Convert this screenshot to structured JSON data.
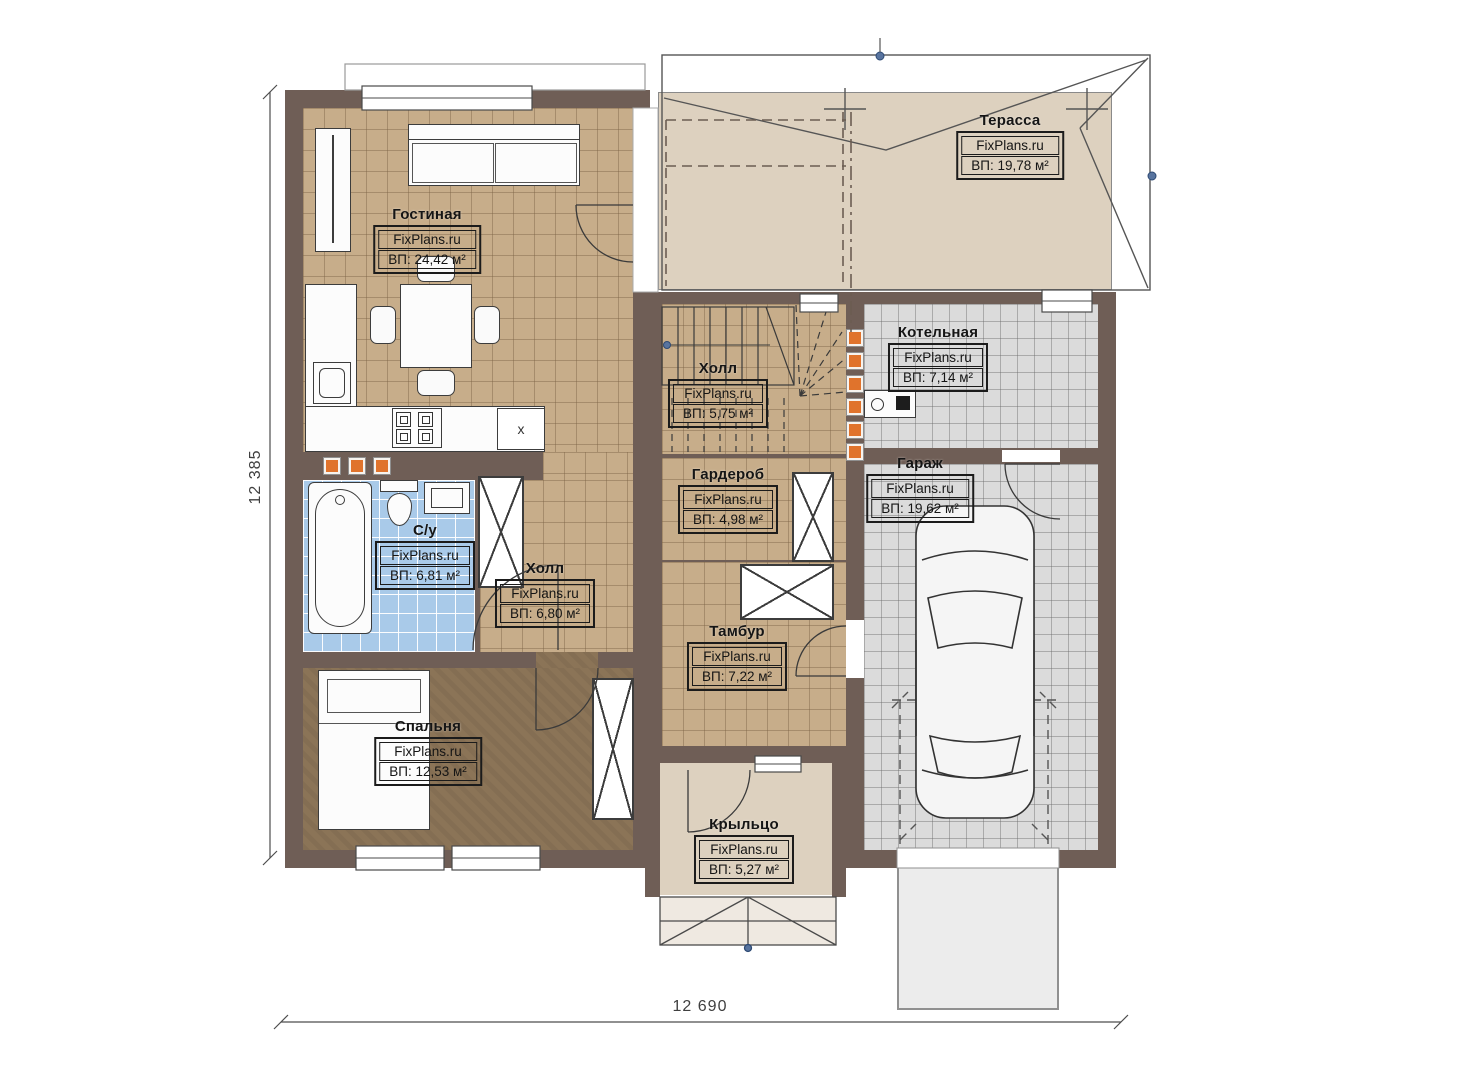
{
  "brand": "FixPlans.ru",
  "dimensions": {
    "left_total": "12 385",
    "bottom_total": "12 690"
  },
  "kitchen": {
    "appliance_mark": "x"
  },
  "colors": {
    "wall": "#6f5e56",
    "floor_tan": "#c7ad8a",
    "floor_blue": "#a9cae9",
    "floor_gray": "#dbdbdb",
    "floor_bedroom": "#8b7457",
    "floor_beige": "#ddd1bf",
    "accent_orange": "#e0732c"
  },
  "rooms": [
    {
      "id": "living-room",
      "name": "Гостиная",
      "brand": "FixPlans.ru",
      "area": "ВП: 24,42 м²"
    },
    {
      "id": "terrace",
      "name": "Терасса",
      "brand": "FixPlans.ru",
      "area": "ВП: 19,78 м²"
    },
    {
      "id": "boiler-room",
      "name": "Котельная",
      "brand": "FixPlans.ru",
      "area": "ВП: 7,14 м²"
    },
    {
      "id": "stair-hall",
      "name": "Холл",
      "brand": "FixPlans.ru",
      "area": "ВП: 5,75 м²"
    },
    {
      "id": "wardrobe-room",
      "name": "Гардероб",
      "brand": "FixPlans.ru",
      "area": "ВП: 4,98 м²"
    },
    {
      "id": "garage",
      "name": "Гараж",
      "brand": "FixPlans.ru",
      "area": "ВП: 19,62 м²"
    },
    {
      "id": "bathroom",
      "name": "С/у",
      "brand": "FixPlans.ru",
      "area": "ВП: 6,81 м²"
    },
    {
      "id": "hall",
      "name": "Холл",
      "brand": "FixPlans.ru",
      "area": "ВП: 6,80 м²"
    },
    {
      "id": "vestibule",
      "name": "Тамбур",
      "brand": "FixPlans.ru",
      "area": "ВП: 7,22 м²"
    },
    {
      "id": "bedroom",
      "name": "Спальня",
      "brand": "FixPlans.ru",
      "area": "ВП: 12,53 м²"
    },
    {
      "id": "porch",
      "name": "Крыльцо",
      "brand": "FixPlans.ru",
      "area": "ВП: 5,27 м²"
    }
  ]
}
